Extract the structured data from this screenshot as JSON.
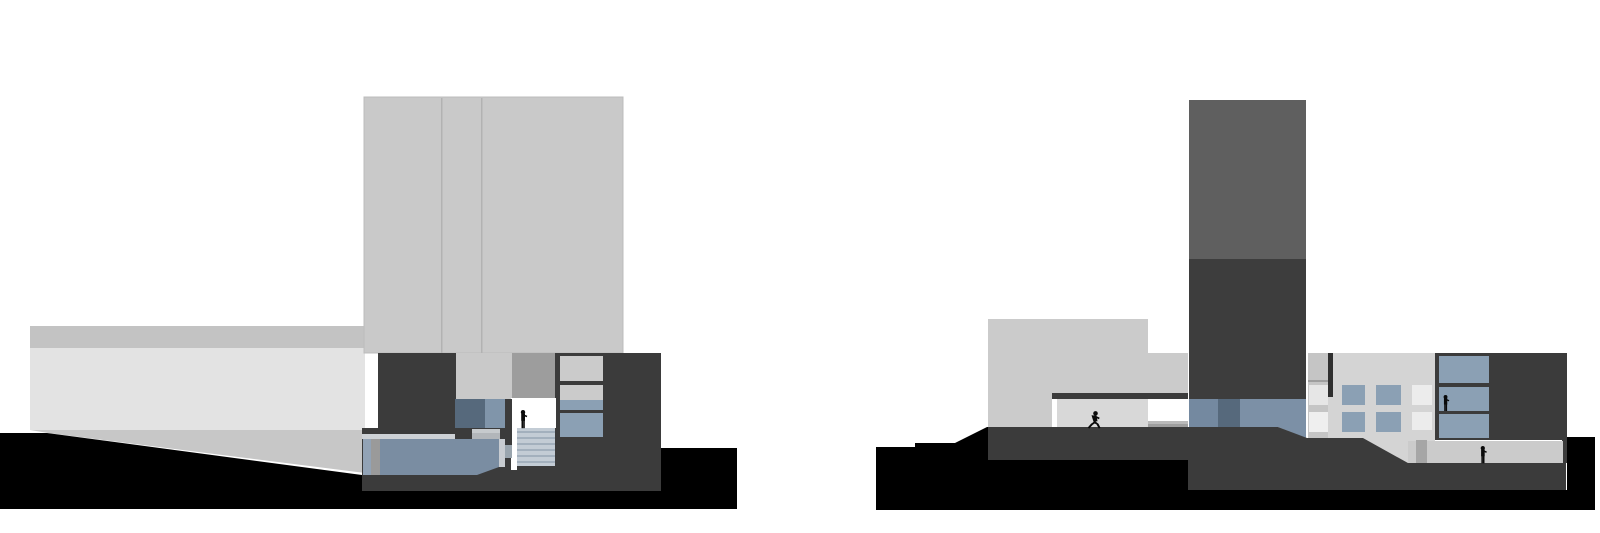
{
  "meta": {
    "description": "Two grayscale architectural building sections side by side with slate-blue glazing, pool water, black ground plane and small human silhouettes",
    "image_type": "architectural-section-drawing"
  },
  "colors": {
    "white": "#ffffff",
    "black": "#000000",
    "figure": "#0a0a0a",
    "towerLight": "#c9c9c9",
    "towerSeam": "#b2b2b2",
    "towerOutline": "#bcbcbc",
    "bandGray": "#c3c3c3",
    "facadeLight": "#e3e3e3",
    "wedgeGray": "#c7c7c7",
    "charcoal": "#3b3b3b",
    "towerUpper": "#5f5f5f",
    "towerLower": "#3d3d3d",
    "blueDark": "#56697c",
    "blueMid": "#7489a0",
    "blueLight": "#7c90a6",
    "bluePanelLight": "#8095aa",
    "windowBlue": "#8ba0b4",
    "poolWater": "#7a8da2",
    "poolEdge": "#92a3b6",
    "grayStrip": "#9a9a9a",
    "deck": "#cdd1d5",
    "stepTop": "#c6cacd",
    "stepFront": "#b2b6ba",
    "shaftGray": "#9d9d9d",
    "stairBase": "#c3ccd5",
    "stairStripe": "#a3b0bd",
    "mullionGray": "#9aa5ae",
    "coping": "#c8ccd1",
    "blockLight": "#cbcbcb",
    "interiorShade": "#d8d8d8",
    "interiorLight": "#d4d4d4",
    "bandLight": "#c5c5c5",
    "seamGray": "#9e9e9e",
    "wallDark": "#2f2f2f",
    "panelWhite": "#ececec",
    "panelWhiteSoft": "#e6e6e6",
    "panelWhiteBright": "#efefef",
    "sillLight": "#b9b9b9",
    "sillDark": "#9e9e9e",
    "walkway": "#cbcbcb",
    "pillar": "#a6a6a6"
  },
  "sections": {
    "left": {
      "figures": [
        {
          "pose": "standing",
          "location": "stair-landing"
        }
      ]
    },
    "right": {
      "figures": [
        {
          "pose": "running",
          "location": "plaza-under-canopy"
        },
        {
          "pose": "standing",
          "location": "upper-window"
        },
        {
          "pose": "standing",
          "location": "lower-walkway"
        }
      ]
    }
  }
}
